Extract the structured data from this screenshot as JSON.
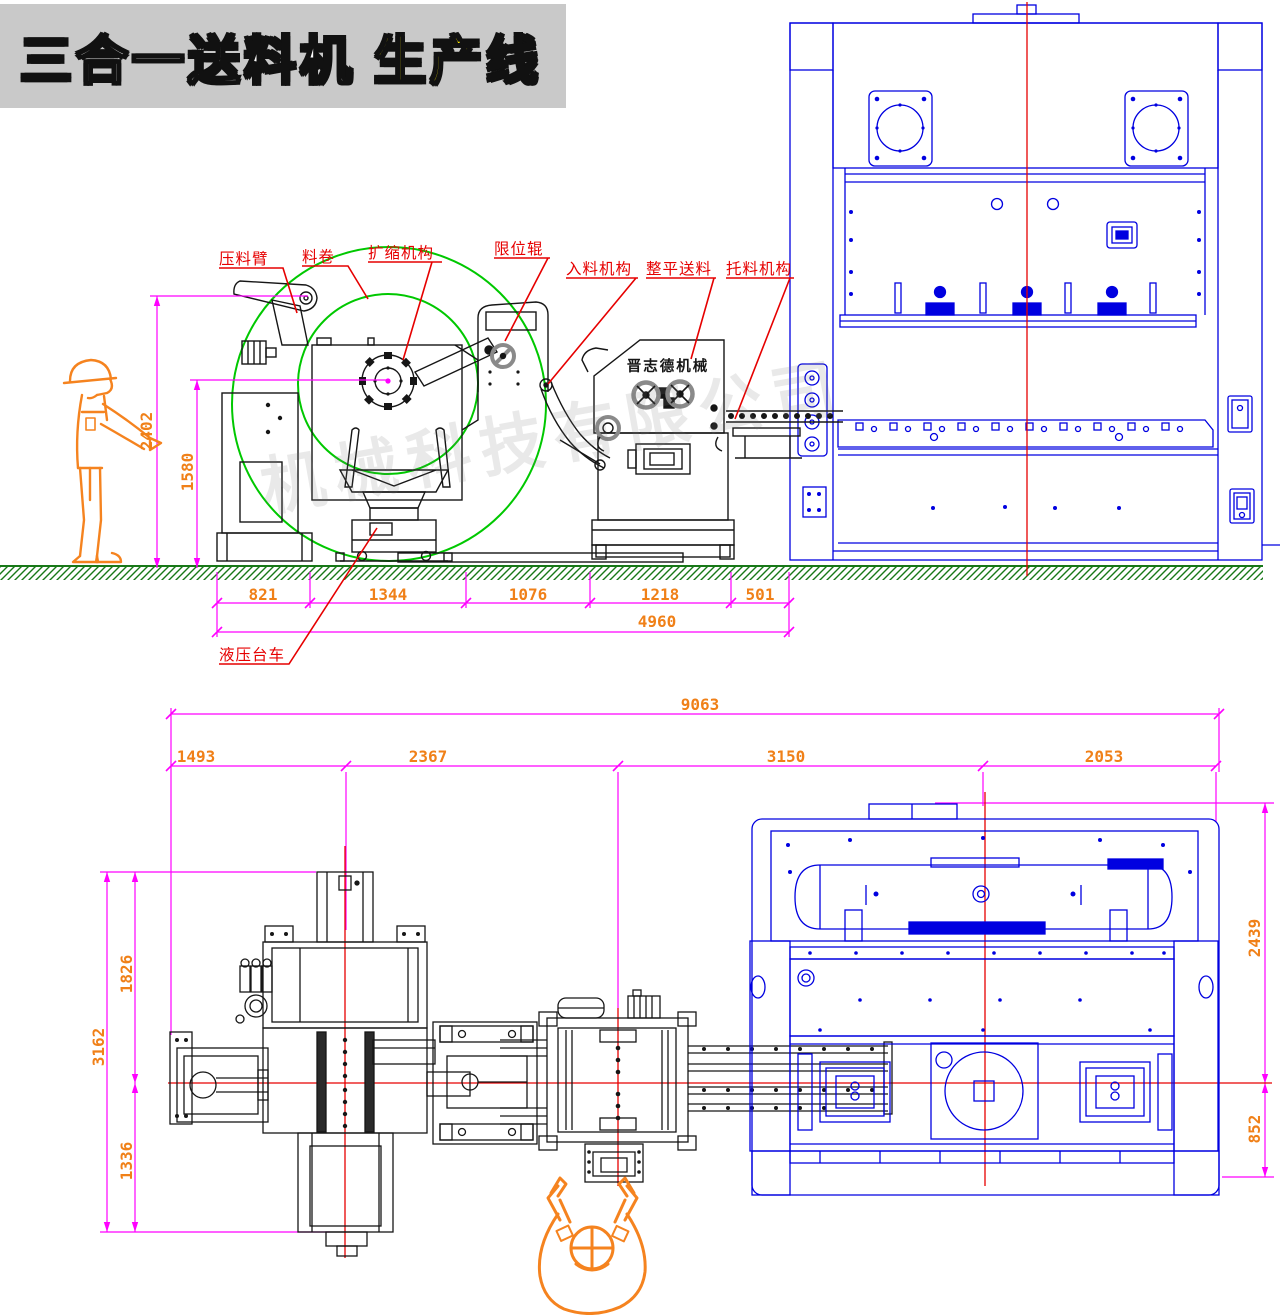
{
  "title": {
    "main": "三合一送料机",
    "highlight": "生产线"
  },
  "watermark": {
    "text": "机械科技有限公司"
  },
  "side_view": {
    "brand_label": "晋志德机械",
    "labels": {
      "press_arm": "压料臂",
      "coil": "料卷",
      "expand": "扩缩机构",
      "limit_roller": "限位辊",
      "infeed": "入料机构",
      "leveler": "整平送料",
      "support": "托料机构",
      "trolley": "液压台车"
    },
    "dims": {
      "total_height": "2402",
      "coil_center_height": "1580",
      "seg1": "821",
      "seg2": "1344",
      "seg3": "1076",
      "seg4": "1218",
      "seg5": "501",
      "total_length": "4960"
    }
  },
  "plan_view": {
    "dims": {
      "total_length": "9063",
      "seg1": "1493",
      "seg2": "2367",
      "seg3": "3150",
      "seg4": "2053",
      "left_total": "3162",
      "left_upper": "1826",
      "left_lower": "1336",
      "press_depth": "2439",
      "press_front": "852"
    }
  },
  "colors": {
    "dimension_line": "#ff00ff",
    "dimension_text": "#f08018",
    "leader_and_centerline": "#e60000",
    "press_blue": "#0000e0",
    "coil_circle_green": "#00c800",
    "ground_green": "#187818",
    "banner_gray": "#c9c9c9",
    "title_highlight": "#ffec00"
  }
}
